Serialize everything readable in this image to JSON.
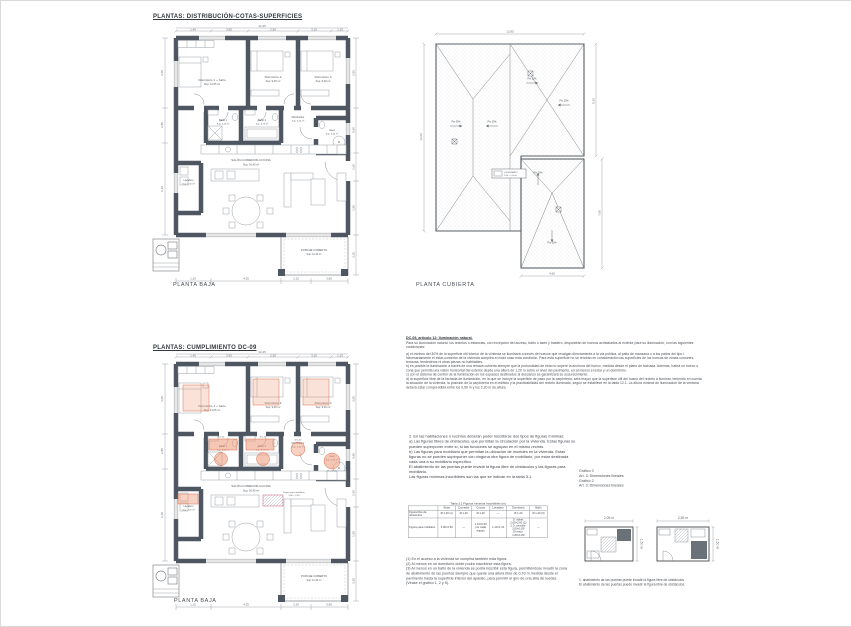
{
  "titles": {
    "section1": "PLANTAS: DISTRIBUCIÓN-COTAS-SUPERFICIES",
    "section2": "PLANTAS: CUMPLIMIENTO DC-09",
    "plan1_caption": "PLANTA BAJA",
    "roof_caption": "PLANTA CUBIERTA",
    "plan2_caption": "PLANTA BAJA"
  },
  "plan": {
    "rooms": {
      "dorm1_name": "Dormitorio 1 + baño",
      "dorm1_area": "Sup: 14,05 m²",
      "dorm2_name": "Dormitorio 2",
      "dorm2_area": "Sup: 9,05 m²",
      "dorm3_name": "Dormitorio 3",
      "dorm3_area": "Sup: 9,00 m²",
      "bano1_name": "Baño 1",
      "bano1_area": "Sup: 4,40 m²",
      "bano2_name": "Baño 2",
      "bano2_area": "Sup: 3,75 m²",
      "aseo_name": "Aseo",
      "aseo_area": "Sup: 4,40 m²",
      "distrib_name": "Distribuidor",
      "distrib_area": "Sup: 5,40 m²",
      "lavadero_name": "Lavadero",
      "lavadero_area": "Sup: 2,05 m²",
      "salon_name": "SALÓN-COMEDOR-COCINA",
      "salon_area": "Sup: 36,40 m²",
      "porche_name": "PORCHE CUBIERTO",
      "porche_area": "Sup: 12,40 m²"
    },
    "dims_top": [
      "1,40",
      "3,65",
      "2,50",
      "3,10",
      "1,15"
    ],
    "dims_top_total": "12,45",
    "dims_left": [
      "3,60",
      "2,85",
      "6,10"
    ],
    "dims_right": [
      "3,55",
      "0,90",
      "2,60",
      "1,50",
      "3,25"
    ],
    "dims_bottom": [
      "1,10",
      "4,35",
      "2,15",
      "3,60"
    ]
  },
  "roof": {
    "slope_label": "Pte 30%",
    "legend_title": "LUCERNARIO",
    "legend_sub": "1,00 × 1,00 m",
    "dim_top": "12,85",
    "dim_left": "13,60",
    "dim_right_upper": "8,10",
    "dim_right_lower": "7,95",
    "dim_bottom": "4,60"
  },
  "plan2": {
    "fig_bath1": "Ø 1,20",
    "fig_bath2": "Ø 1,20",
    "fig_aseo": "Ø 1,20 (3)",
    "fig_distrib": "Ø 1,20",
    "fig_mob_title": "Figura para mobiliario",
    "fig_mob_dim": "3,00 × 2,50"
  },
  "texts": {
    "blockA_title": "DC-09, artículo 12: Iluminación natural.",
    "blockA_intro": "Para su iluminación natural, los recintos o estancias, con excepción del acceso, baño o aseo y trastero, dispondrán de huecos acristalados al exterior para su iluminación, con las siguientes condiciones:",
    "blockA_body": "a) el mínimo del 30% de la superficie útil interior de la vivienda se iluminará a través de huecos que recaigan directamente a la vía pública, al patio de manzana o a los patios del tipo I. Necesariamente el estar-comedor de la vivienda cumplirá en todo caso esta condición. Para esta superficie no se tendrán en consideración las superficies de los huecos de zonas comunes, terrazas, tendederos ni otras piezas no habitables.\nb) es posible la iluminación a través de una terraza cubierta siempre que la profundidad de ésta no supere la anchura del hueco, medida desde el plano de fachada. Además, habrá un hueco o zona que permita una visión horizontal del exterior desde una altura de 1,20 m sobre el nivel del pavimento, en al menos el estar y un dormitorio.\nc) con el sistema de control de la iluminación en los espacios destinados al descanso se garantizará su oscurecimiento.\nd) la superficie libre de la fachada de iluminación, en la que se incluye la superficie de paso por la carpintería, será mayor que la superficie útil del hueco del recinto a iluminar, teniendo en cuenta la situación de la vivienda, la posición de la carpintería en el edificio y la practicabilidad del recinto iluminado, según se establece en la tabla 12.1. La altura mínima de iluminación de la ventana deberá estar comprendida entre los 0,50 m y los 2,20 m de altura.",
    "blockB": "2. En las habitaciones o recintos deberán poder inscribirse dos tipos de figuras mínimas:\na) Las figuras libres de obstáculos, que permitan la circulación por la vivienda. Estas figuras se pueden superponer entre sí, si las funciones se agrupan en el mismo recinto.\nb) Las figuras para mobiliario que permitan la ubicación de muebles en la vivienda. Estas figuras no se pueden superponer con ninguna otra figura de mobiliario, por estar destinada cada una a su mobiliario específico.\nEl abatimiento de las puertas puede invadir la figura libre de obstáculos y las figuras para mobiliario.\nLas figuras mínimas inscribibles son las que se indican en la tabla 3.1.",
    "side_labels": "Gráfico 3\nArt. 3: Dimensiones lineales\nGráfico 2\nArt. 3: Dimensiones lineales",
    "footnotes": "(1) En el acceso a la vivienda se cumplirá también esta figura.\n(2) Al menos en un dormitorio doble podrá inscribirse esta figura.\n(3) Al menos en un baño de la vivienda se podrá inscribir esta figura, permitiéndose invadir la zona de abatimiento de las puertas siempre que quede una altura libre de 0,70 m medida desde el pavimento hasta la superficie inferior del aparato, para permitir el giro de una silla de ruedas.\n(Véase el gráfico 1, 2 y 5).",
    "caption1": "1. abatimiento de las puertas puede invadir la figura libre de obstáculos",
    "caption2": "El abatimiento de las puertas puede invadir la figura libre de obstáculos."
  },
  "table": {
    "title": "Tabla 3.1  Figuras mínimas inscribibles (m)",
    "headers": [
      "",
      "Estar",
      "Comedor",
      "Cocina",
      "Lavadero",
      "Dormitorio",
      "Baño"
    ],
    "row1_label": "Figura libre de obstáculos",
    "row1": [
      "Ø 1,20 (1)",
      "Ø 1,20",
      "Ø 1,20",
      "—",
      "Ø 1,20",
      "Ø 1,20 (3)"
    ],
    "row2_label": "Figura para mobiliario",
    "row2": [
      "3,00×2,50",
      "—",
      "1,10×0,60\npor cada\nequipo",
      "1,10×1,10",
      "D. doble:\n2,60×2,60 (2)\n1 D. sencillo:\n2,00×1,80\nEl resto:\n1,80×1,80",
      "—"
    ]
  },
  "diagrams": {
    "d1_w": "2,05 m",
    "d1_h": "1,50 m",
    "d2_w": "2,65 m",
    "d2_h": "1,50 m"
  }
}
